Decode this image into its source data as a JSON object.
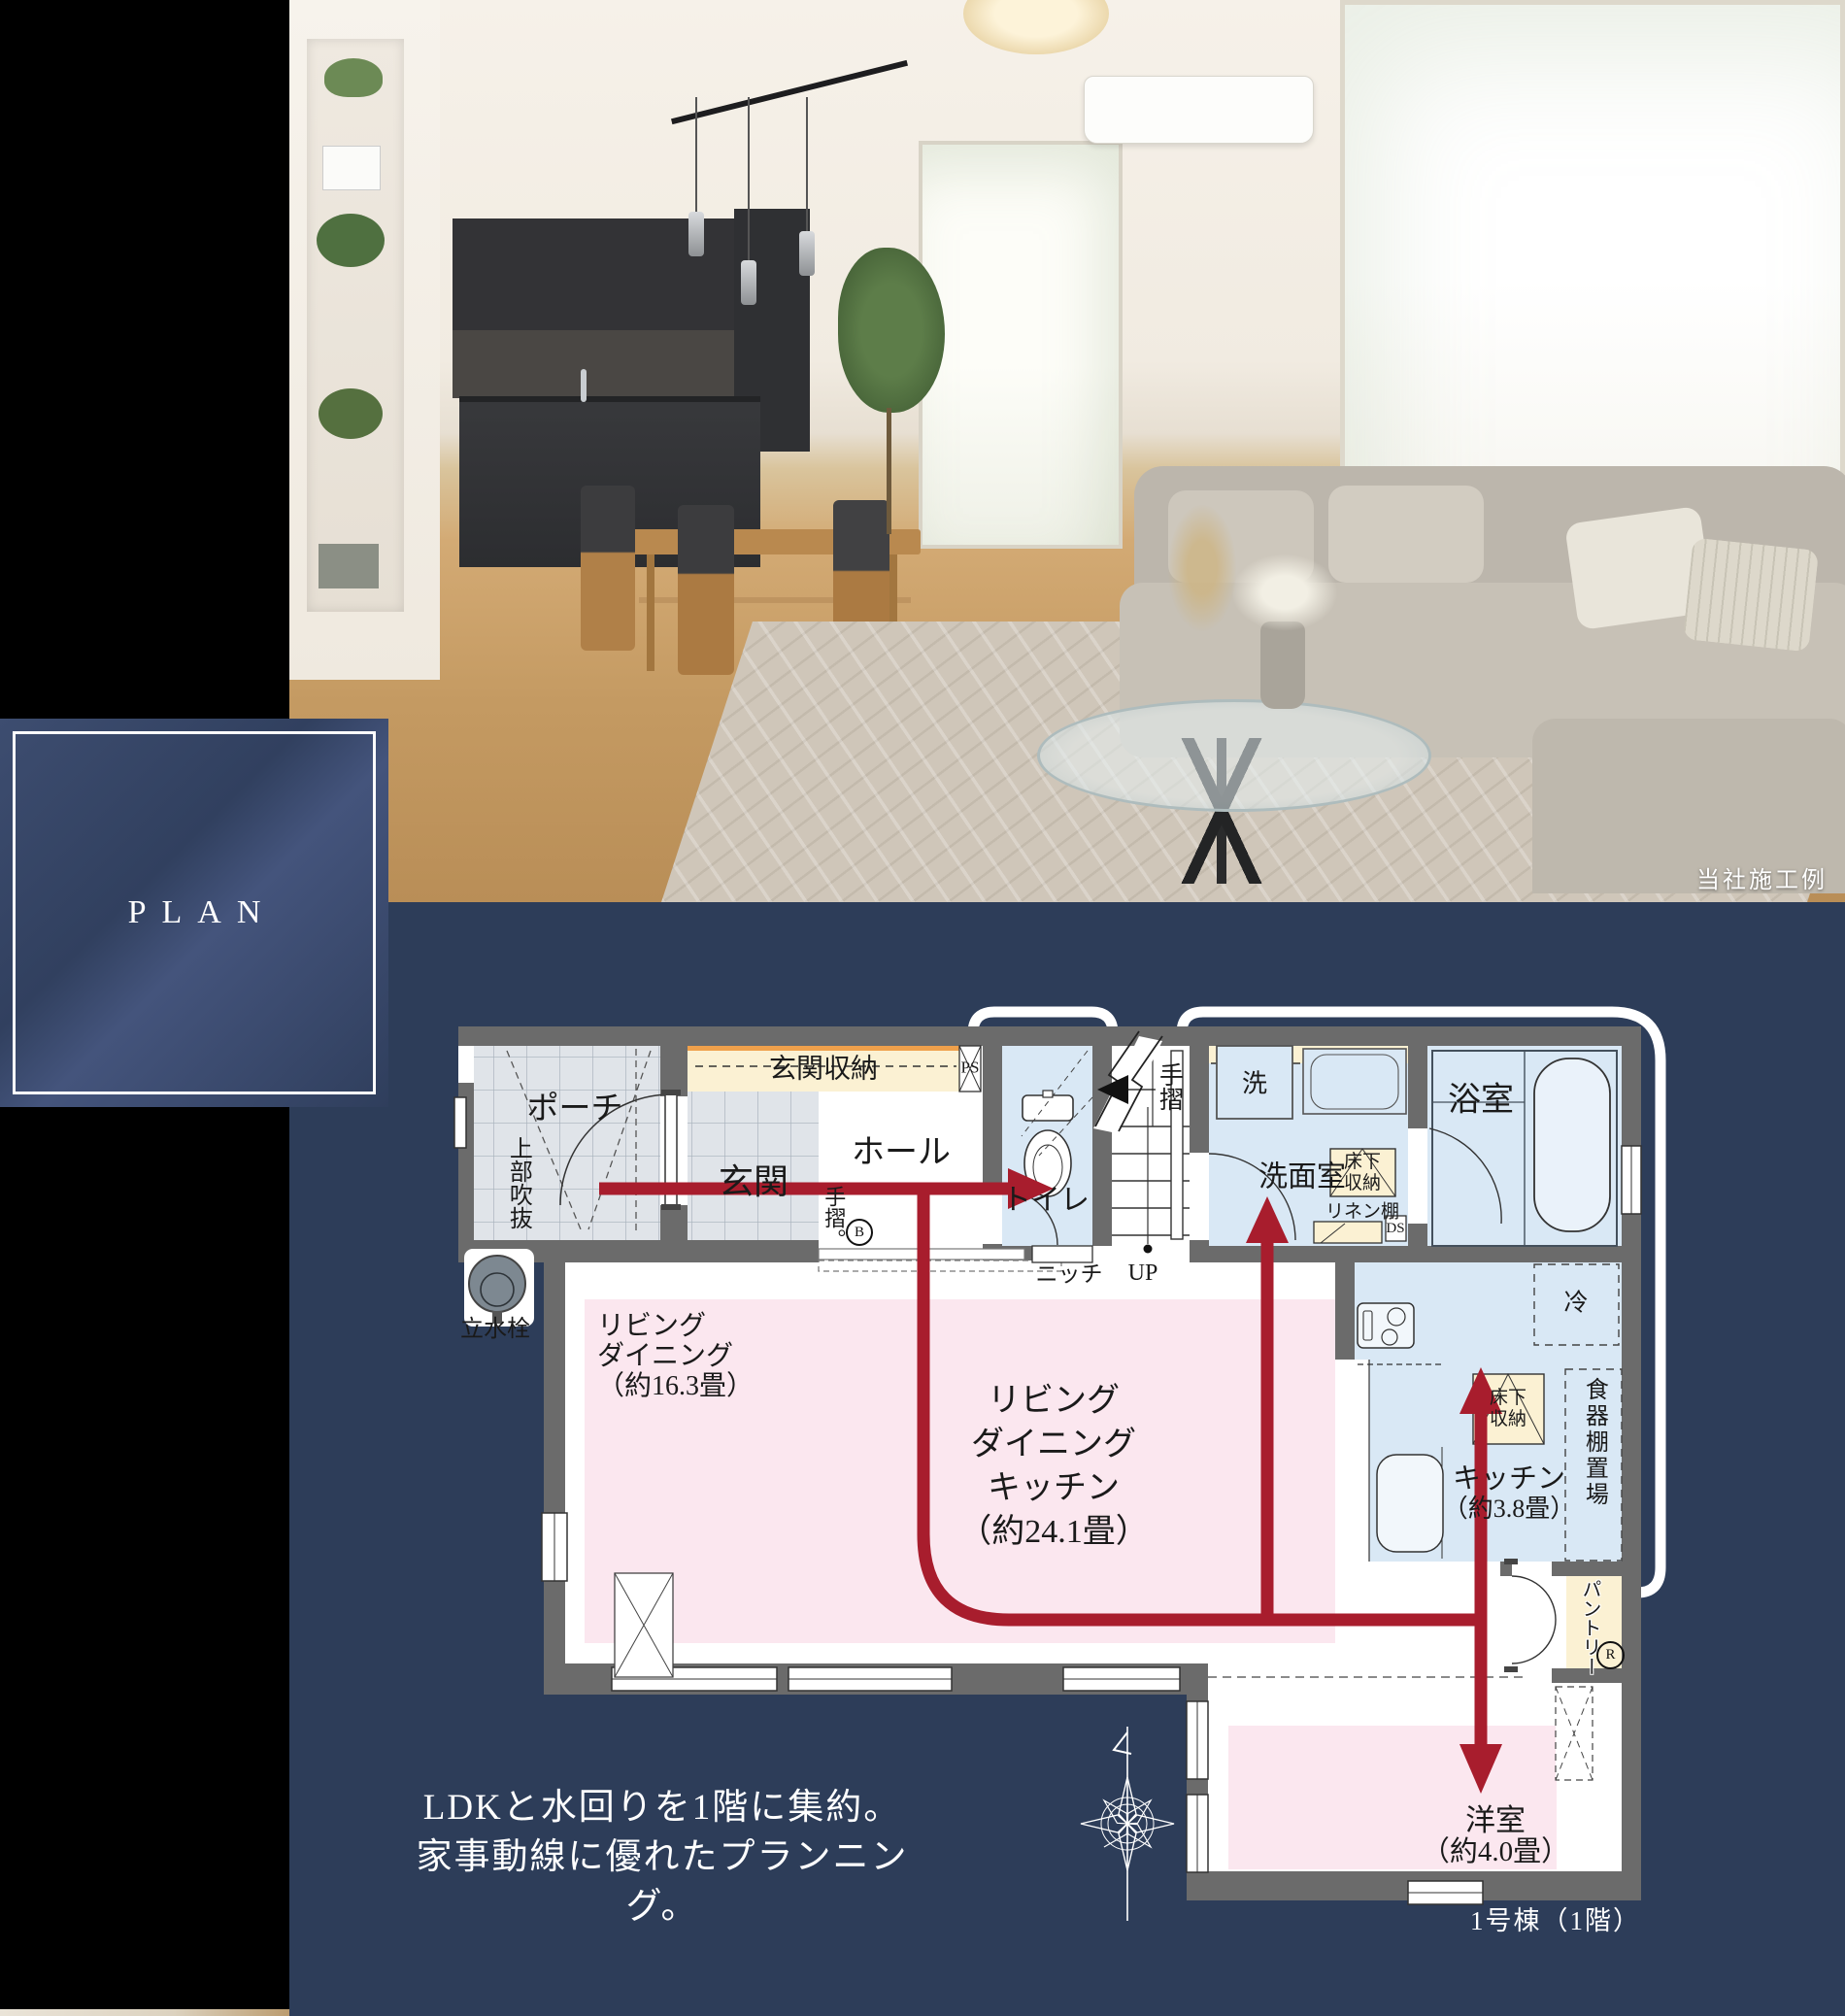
{
  "colors": {
    "navy": "#2d3d59",
    "red_arrow": "#a81d2d",
    "wall_gray": "#6b6b6b",
    "room_blue": "#d9e8f5",
    "room_pink": "#fbe7ef",
    "cream": "#fbf1d3",
    "accent_orange": "#efa04b"
  },
  "photo": {
    "caption": "当社施工例"
  },
  "plan_badge": {
    "label": "PLAN"
  },
  "plan": {
    "catch_copy": {
      "line1": "LDKと水回りを1階に集約。",
      "line2": "家事動線に優れたプランニング。"
    },
    "unit_label": "1号棟（1階）",
    "rooms": {
      "porch": "ポーチ",
      "void_above": "上部吹抜",
      "faucet": "立水栓",
      "entrance": "玄関",
      "entrance_storage": "玄関収納",
      "hall": "ホール",
      "ps": "PS",
      "handrail_entrance": "手摺。",
      "handrail_entrance_mark": "B",
      "toilet": "トイレ",
      "handrail_stairs": "手摺",
      "niche": "ニッチ",
      "up": "UP",
      "washer": "洗",
      "washroom": "洗面室",
      "underfloor_storage_wash": "床下収納",
      "linen_shelf": "リネン棚",
      "ds": "DS",
      "bath": "浴室",
      "fridge": "冷",
      "underfloor_storage_kitchen": "床下収納",
      "kitchen_name": "キッチン",
      "kitchen_size": "（約3.8畳）",
      "dish_shelf": "食器棚置場",
      "pantry": "パントリー",
      "pantry_mark": "R",
      "ld_line1": "リビング",
      "ld_line2": "ダイニング",
      "ld_line3": "（約16.3畳）",
      "ldk_line1": "リビング",
      "ldk_line2": "ダイニング",
      "ldk_line3": "キッチン",
      "ldk_line4": "（約24.1畳）",
      "western_name": "洋室",
      "western_size": "（約4.0畳）"
    }
  }
}
